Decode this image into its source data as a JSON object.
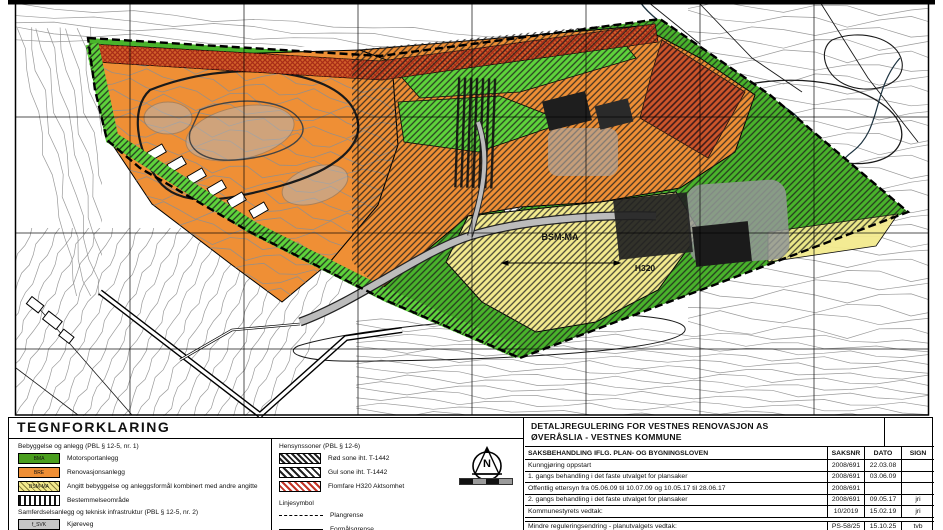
{
  "map": {
    "labels": [
      {
        "text": "BSM-MA",
        "x": 560,
        "y": 240,
        "size": 9
      },
      {
        "text": "H320",
        "x": 645,
        "y": 271,
        "size": 8.5
      }
    ],
    "colors": {
      "motorsport_green": "#4a9e1e",
      "renovation_orange": "#ef8f35",
      "combined_yellow": "#f3ea8e",
      "flood_red": "#b3301e",
      "road_gray": "#bcbcbc",
      "contour_gray": "#8f8f8f"
    }
  },
  "legend": {
    "title": "TEGNFORKLARING",
    "sections": [
      {
        "heading": "Bebyggelse og anlegg (PBL § 12-5, nr. 1)",
        "items": [
          {
            "code": "BMA",
            "swatch": "green",
            "label": "Motorsportanlegg"
          },
          {
            "code": "BRE",
            "swatch": "orange",
            "label": "Renovasjonsanlegg"
          },
          {
            "code": "BSM-MA",
            "swatch": "yellow-hatch",
            "label": "Angitt bebyggelse og anleggsformål kombinert med andre angitte"
          },
          {
            "code": "",
            "swatch": "vertical-stripes",
            "label": "Bestemmelseområde"
          }
        ]
      },
      {
        "heading": "Samferdselsanlegg og teknisk infrastruktur (PBL § 12-5, nr. 2)",
        "items": [
          {
            "code": "f_SVK",
            "swatch": "gray",
            "label": "Kjøreveg"
          }
        ]
      },
      {
        "heading": "Landbruks-, natur- og friluftsformål samt reindrift (PBL § 12-5, nr. 5)",
        "items": []
      }
    ],
    "hensynssoner": {
      "heading": "Hensynssoner (PBL § 12-6)",
      "items": [
        {
          "swatch": "black-hatch-dense",
          "label": "Rød sone iht. T-1442"
        },
        {
          "swatch": "black-hatch",
          "label": "Gul sone iht. T-1442"
        },
        {
          "swatch": "red-hatch",
          "label": "Flomfare H320 Aktsomhet"
        }
      ]
    },
    "linjesymbol": {
      "heading": "Linjesymbol",
      "items": [
        {
          "style": "dashed",
          "label": "Plangrense"
        },
        {
          "style": "solid",
          "label": "Formålsgrense"
        },
        {
          "style": "arrow",
          "label": "Måle og avstandslinje"
        }
      ]
    },
    "north_label": "N"
  },
  "title_block": {
    "title_line1": "DETALJREGULERING FOR VESTNES RENOVASJON AS",
    "title_line2": "ØVERÅSLIA - VESTNES KOMMUNE",
    "table": {
      "header": {
        "description": "SAKSBEHANDLING IFLG. PLAN- OG BYGNINGSLOVEN",
        "saksnr": "SAKSNR",
        "dato": "DATO",
        "sign": "SIGN"
      },
      "rows": [
        {
          "description": "Kunngjøring oppstart",
          "saksnr": "2008/691",
          "dato": "22.03.08",
          "sign": ""
        },
        {
          "description": "1. gangs behandling i det faste utvalget for plansaker",
          "saksnr": "2008/691",
          "dato": "03.06.09",
          "sign": ""
        },
        {
          "description": "Offentlig ettersyn fra 05.06.09  til 10.07.09    og    10.05.17  til  28.06.17",
          "saksnr": "2008/691",
          "dato": "",
          "sign": ""
        },
        {
          "description": "2. gangs behandling i det faste utvalget for plansaker",
          "saksnr": "2008/691",
          "dato": "09.05.17",
          "sign": "jri"
        },
        {
          "description": "Kommunestyrets vedtak:",
          "saksnr": "10/2019",
          "dato": "15.02.19",
          "sign": "jri"
        },
        {
          "description": "Mindre reguleringsendring - planutvalgets vedtak:",
          "saksnr": "PS-58/25",
          "dato": "15.10.25",
          "sign": "tvb"
        }
      ]
    }
  }
}
